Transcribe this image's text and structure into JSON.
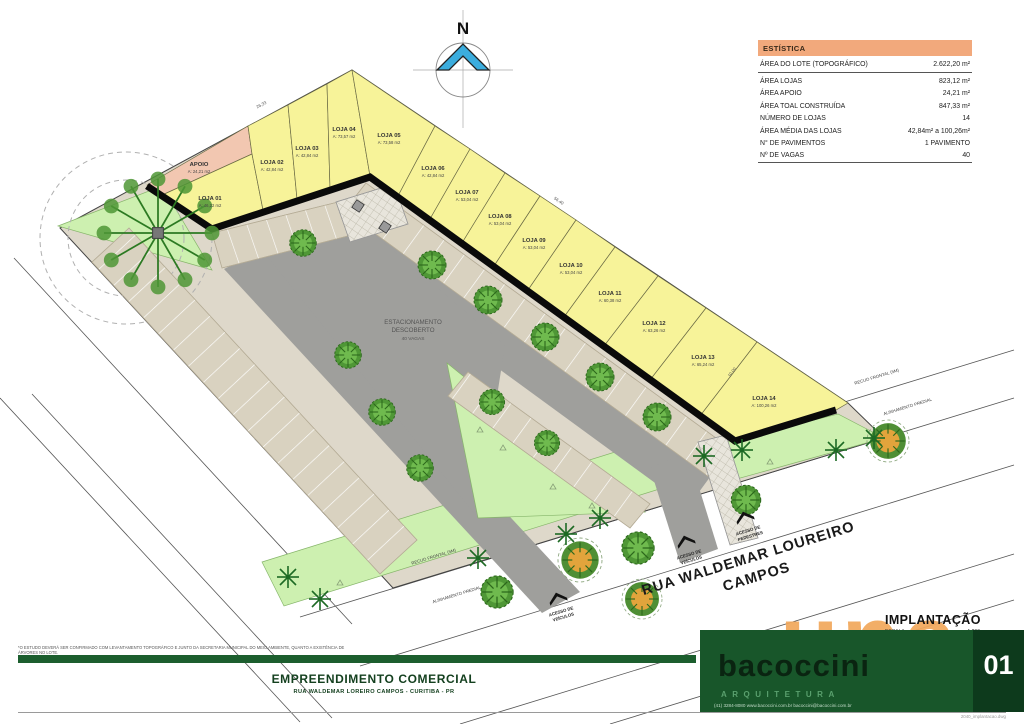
{
  "plan": {
    "north_label": "N",
    "parking": {
      "l1": "ESTACIONAMENTO",
      "l2": "DESCOBERTO",
      "l3": "40 VAGAS"
    },
    "street": {
      "l1": "RUA WALDEMAR LOUREIRO",
      "l2": "CAMPOS"
    },
    "access_vehicles": {
      "l1": "ACESSO DE",
      "l2": "VEÍCULOS"
    },
    "access_pedestrians": {
      "l1": "ACESSO DE",
      "l2": "PEDESTRES"
    },
    "recuo_label": "RECUO FRONTAL (5M)",
    "alinhamento_label": "ALINHAMENTO PREDIAL",
    "dim_top": "26,33",
    "dim_right": "56,40",
    "dim_lot14": "10,00"
  },
  "lots": [
    {
      "name": "APOIO",
      "area": "A: 24,21 m2"
    },
    {
      "name": "LOJA 01",
      "area": "A: 46,22 m2"
    },
    {
      "name": "LOJA 02",
      "area": "A: 42,84 m2"
    },
    {
      "name": "LOJA 03",
      "area": "A: 42,84 m2"
    },
    {
      "name": "LOJA 04",
      "area": "A: 73,57 m2"
    },
    {
      "name": "LOJA 05",
      "area": "A: 73,58 m2"
    },
    {
      "name": "LOJA 06",
      "area": "A: 42,84 m2"
    },
    {
      "name": "LOJA 07",
      "area": "A: 53,04 m2"
    },
    {
      "name": "LOJA 08",
      "area": "A: 53,04 m2"
    },
    {
      "name": "LOJA 09",
      "area": "A: 53,04 m2"
    },
    {
      "name": "LOJA 10",
      "area": "A: 53,04 m2"
    },
    {
      "name": "LOJA 11",
      "area": "A: 60,38 m2"
    },
    {
      "name": "LOJA 12",
      "area": "A: 63,26 m2"
    },
    {
      "name": "LOJA 13",
      "area": "A: 65,24 m2"
    },
    {
      "name": "LOJA 14",
      "area": "A: 100,26 m2"
    }
  ],
  "stats": {
    "title": "ESTÍSTICA",
    "rows": [
      {
        "label": "ÁREA DO LOTE (TOPOGRÁFICO)",
        "value": "2.622,20 m²"
      },
      {
        "label": "ÁREA LOJAS",
        "value": "823,12 m²"
      },
      {
        "label": "ÁREA APOIO",
        "value": "24,21 m²"
      },
      {
        "label": "ÁREA TOAL CONSTRUÍDA",
        "value": "847,33 m²"
      },
      {
        "label": "NÚMERO DE LOJAS",
        "value": "14"
      },
      {
        "label": "ÁREA MÉDIA DAS LOJAS",
        "value": "42,84m² a 100,26m²"
      },
      {
        "label": "N° DE PAVIMENTOS",
        "value": "1 PAVIMENTO"
      },
      {
        "label": "Nº DE VAGAS",
        "value": "40"
      }
    ]
  },
  "titleblock": {
    "project": "EMPREENDIMENTO COMERCIAL",
    "address": "RUA WALDEMAR LOREIRO CAMPOS - CURITIBA - PR",
    "drawing_title": "IMPLANTAÇÃO",
    "scale_label": "ESCALA",
    "scale_value": "1:200",
    "sheet_number": "01",
    "brand": "bacoccini",
    "brand_sub": "ARQUITETURA",
    "brand_contact": "(41) 3284-8080   www.bacoccini.com.br   bacoccini@bacoccini.com.br",
    "watermark": "una",
    "file_label": "2040_implantacao.dwg",
    "disclaimer1": "*O ESTUDO DEVERÁ SER CONFIRMADO COM LEVANTAMENTO TOPOGRÁFICO E JUNTO DA SECRETARIA MUNICIPAL DO MEIO AMBIENTE, QUANTO A EXISTÊNCIA DE ÁRVORES NO LOTE.",
    "disclaimer2": "TODAVIA ESTE CONFIRMADO SE FOR NECESSÁRIO ÁREA DE DOAÇÃO JUNTO AO MUNICÍPIO."
  },
  "colors": {
    "lot_yellow": "#f7f399",
    "apoio_pink": "#f2c7b1",
    "road_gray": "#9f9f9c",
    "stall_beige": "#d9d2c0",
    "green": "#cdf0b0",
    "wall_black": "#0a0a0a",
    "stats_header": "#f2a97c",
    "title_green": "#1c5e2e",
    "sheet_green": "#0d3a1c",
    "watermark_orange": "#f2a85c",
    "north_blue": "#3badde"
  }
}
